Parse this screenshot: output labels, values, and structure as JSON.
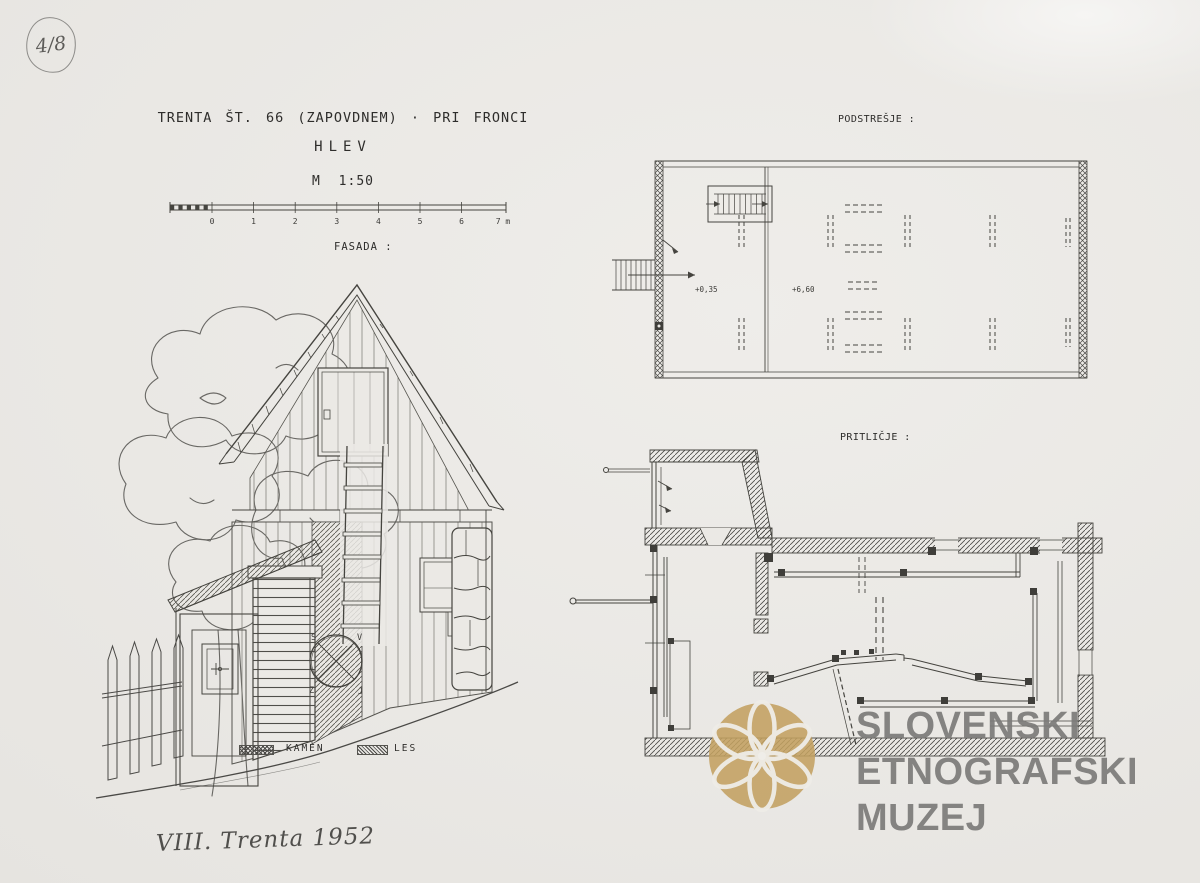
{
  "sheet": {
    "number": "4/8",
    "note": "VIII. Trenta 1952"
  },
  "title": {
    "line1": "TRENTA ŠT. 66 (ZAPOVDNEM) · PRI FRONCI",
    "line2": "HLEV",
    "scale": "M 1:50"
  },
  "scale_bar": {
    "ticks": [
      "0",
      "1",
      "2",
      "3",
      "4",
      "5",
      "6",
      "7 m"
    ]
  },
  "sections": {
    "facade": "FASADA :",
    "attic": "PODSTREŠJE :",
    "ground": "PRITLIČJE :"
  },
  "attic_plan": {
    "elevation_left": "+0,35",
    "elevation_right": "+6,60"
  },
  "compass": {
    "nw": "S",
    "ne": "V",
    "sw": "Z",
    "se": "J"
  },
  "legend": {
    "stone": "KAMEN",
    "wood": "LES"
  },
  "watermark": {
    "line1": "SLOVENSKI",
    "line2": "ETNOGRAFSKI",
    "line3": "MUZEJ"
  },
  "colors": {
    "paper": "#ebe9e5",
    "ink": "#2e2d2b",
    "drawing_stroke": "#45443f",
    "pencil": "#5f5e5c",
    "logo_gold": "#c2a05f",
    "watermark_text": "#7c7b79"
  },
  "icons": {
    "museum_logo": "six-petal-rosette",
    "compass_rose": "crossed-circle"
  }
}
